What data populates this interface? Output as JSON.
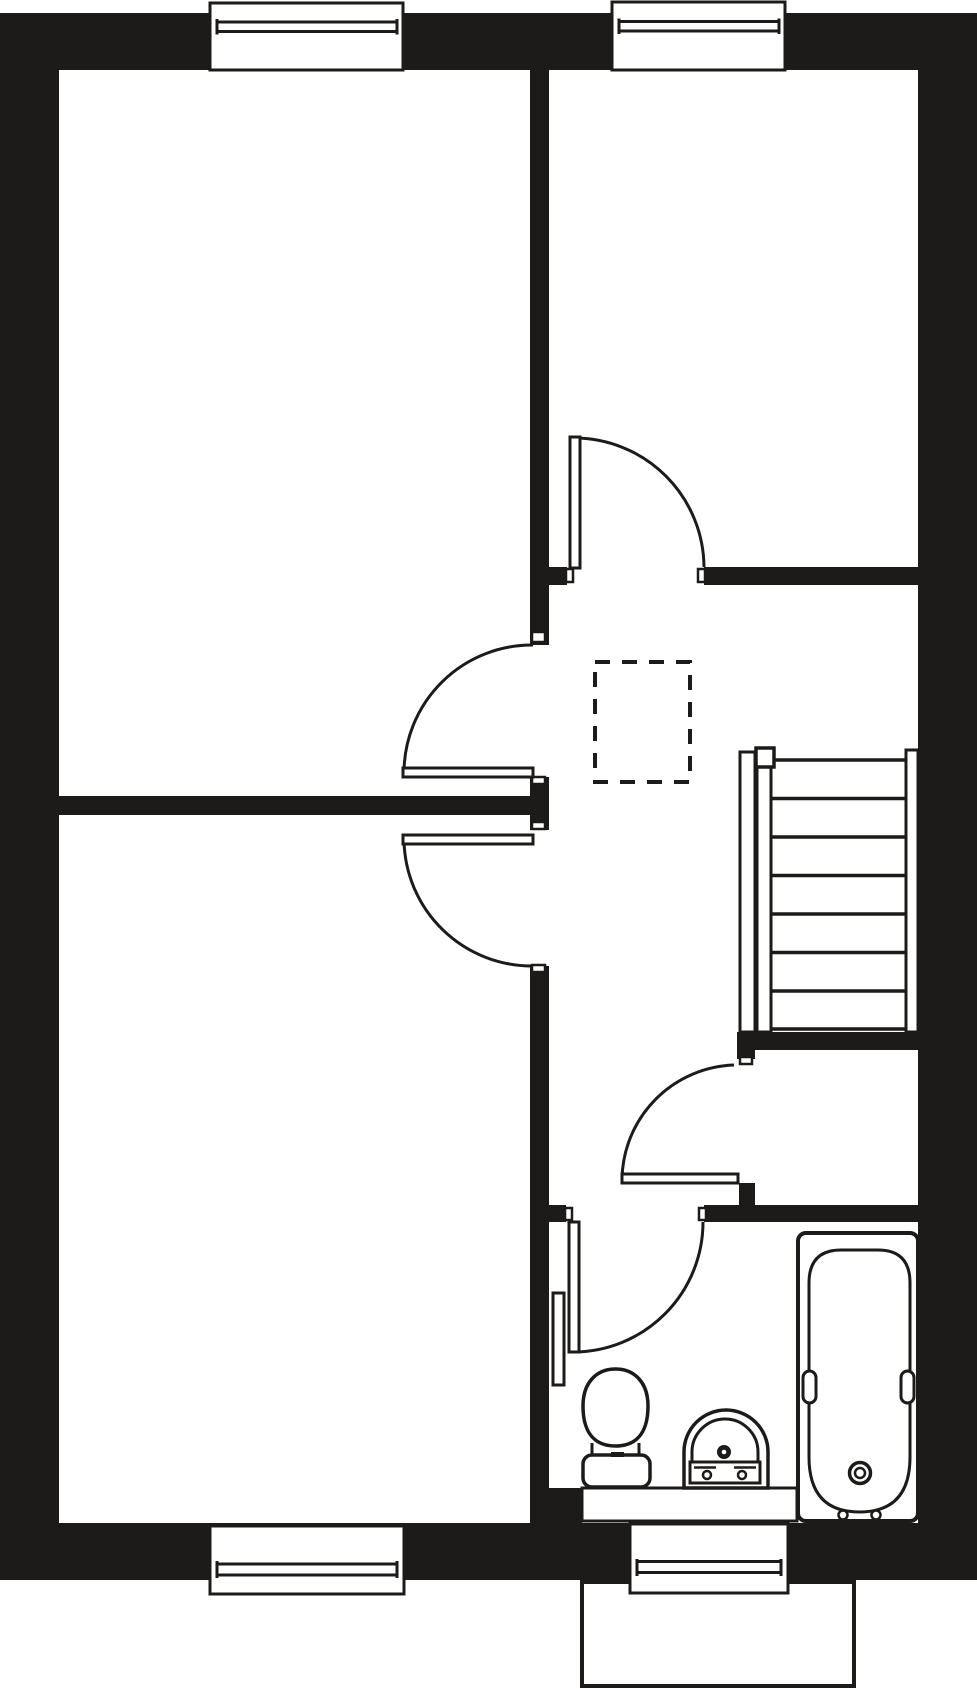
{
  "plan": {
    "w": 977,
    "h": 1689,
    "bg": "#ffffff",
    "ink": "#1d1b19"
  },
  "primitives": [
    {
      "kind": "rect",
      "name": "top-wall",
      "x": 0,
      "y": 13,
      "w": 977,
      "h": 57,
      "fill": "ink"
    },
    {
      "kind": "rect",
      "name": "left-wall",
      "x": 0,
      "y": 13,
      "w": 59,
      "h": 1566,
      "fill": "ink"
    },
    {
      "kind": "rect",
      "name": "right-wall",
      "x": 918,
      "y": 13,
      "w": 59,
      "h": 1566,
      "fill": "ink"
    },
    {
      "kind": "rect",
      "name": "bottom-wall",
      "x": 0,
      "y": 1523,
      "w": 977,
      "h": 57,
      "fill": "ink"
    },
    {
      "kind": "rect",
      "name": "partition-upper-wall",
      "x": 530,
      "y": 70,
      "w": 19,
      "h": 575,
      "fill": "ink"
    },
    {
      "kind": "rect",
      "name": "partition-mid-pier",
      "x": 530,
      "y": 777,
      "w": 19,
      "h": 53,
      "fill": "ink"
    },
    {
      "kind": "rect",
      "name": "partition-lower-wall",
      "x": 530,
      "y": 966,
      "w": 19,
      "h": 524,
      "fill": "ink"
    },
    {
      "kind": "rect",
      "name": "bath-sw-pier",
      "x": 530,
      "y": 1488,
      "w": 52,
      "h": 37,
      "fill": "ink"
    },
    {
      "kind": "rect",
      "name": "left-rooms-divider-wall",
      "x": 59,
      "y": 796,
      "w": 471,
      "h": 19,
      "fill": "ink"
    },
    {
      "kind": "rect",
      "name": "topright-room-south-stub",
      "x": 549,
      "y": 567,
      "w": 18,
      "h": 18,
      "fill": "ink"
    },
    {
      "kind": "rect",
      "name": "topright-room-south-wall",
      "x": 704,
      "y": 567,
      "w": 214,
      "h": 18,
      "fill": "ink"
    },
    {
      "kind": "rect",
      "name": "understairs-wall",
      "x": 737,
      "y": 1032,
      "w": 181,
      "h": 18,
      "fill": "ink"
    },
    {
      "kind": "rect",
      "name": "understairs-pier",
      "x": 737,
      "y": 1050,
      "w": 18,
      "h": 9,
      "fill": "ink"
    },
    {
      "kind": "rect",
      "name": "store-door-pier",
      "x": 739,
      "y": 1183,
      "w": 16,
      "h": 22,
      "fill": "ink"
    },
    {
      "kind": "rect",
      "name": "bathroom-north-stub",
      "x": 548,
      "y": 1205,
      "w": 18,
      "h": 17,
      "fill": "ink"
    },
    {
      "kind": "rect",
      "name": "bathroom-north-wall",
      "x": 704,
      "y": 1205,
      "w": 214,
      "h": 17,
      "fill": "ink"
    },
    {
      "kind": "rect",
      "name": "porch-outline",
      "x": 582,
      "y": 1582,
      "w": 272,
      "h": 104,
      "fill": "bg",
      "stroke": "ink",
      "sw": 4
    },
    {
      "kind": "rect",
      "name": "window-top-left-frame",
      "x": 210,
      "y": 3,
      "w": 193,
      "h": 67,
      "fill": "bg",
      "stroke": "ink",
      "sw": 3
    },
    {
      "kind": "line",
      "name": "window-top-left-glazing-1",
      "x1": 217,
      "y1": 22,
      "x2": 397,
      "y2": 22,
      "stroke": "ink",
      "sw": 3
    },
    {
      "kind": "line",
      "name": "window-top-left-glazing-2",
      "x1": 217,
      "y1": 31.5,
      "x2": 397,
      "y2": 31.5,
      "stroke": "ink",
      "sw": 3
    },
    {
      "kind": "line",
      "name": "window-top-left-cap-l",
      "x1": 217,
      "y1": 19,
      "x2": 217,
      "y2": 34.5,
      "stroke": "ink",
      "sw": 3
    },
    {
      "kind": "line",
      "name": "window-top-left-cap-r",
      "x1": 397,
      "y1": 19,
      "x2": 397,
      "y2": 34.5,
      "stroke": "ink",
      "sw": 3
    },
    {
      "kind": "rect",
      "name": "window-top-right-frame",
      "x": 612,
      "y": 2,
      "w": 173,
      "h": 68,
      "fill": "bg",
      "stroke": "ink",
      "sw": 3
    },
    {
      "kind": "line",
      "name": "window-top-right-glazing-1",
      "x1": 619,
      "y1": 21.5,
      "x2": 779,
      "y2": 21.5,
      "stroke": "ink",
      "sw": 3
    },
    {
      "kind": "line",
      "name": "window-top-right-glazing-2",
      "x1": 619,
      "y1": 31,
      "x2": 779,
      "y2": 31,
      "stroke": "ink",
      "sw": 3
    },
    {
      "kind": "line",
      "name": "window-top-right-cap-l",
      "x1": 619,
      "y1": 18.5,
      "x2": 619,
      "y2": 34,
      "stroke": "ink",
      "sw": 3
    },
    {
      "kind": "line",
      "name": "window-top-right-cap-r",
      "x1": 779,
      "y1": 18.5,
      "x2": 779,
      "y2": 34,
      "stroke": "ink",
      "sw": 3
    },
    {
      "kind": "rect",
      "name": "window-bottom-left-frame",
      "x": 210,
      "y": 1526,
      "w": 194,
      "h": 68,
      "fill": "bg",
      "stroke": "ink",
      "sw": 3
    },
    {
      "kind": "line",
      "name": "window-bottom-left-glazing-1",
      "x1": 217,
      "y1": 1564,
      "x2": 397,
      "y2": 1564,
      "stroke": "ink",
      "sw": 3
    },
    {
      "kind": "line",
      "name": "window-bottom-left-glazing-2",
      "x1": 217,
      "y1": 1575,
      "x2": 397,
      "y2": 1575,
      "stroke": "ink",
      "sw": 3
    },
    {
      "kind": "line",
      "name": "window-bottom-left-cap-l",
      "x1": 217,
      "y1": 1561,
      "x2": 217,
      "y2": 1578,
      "stroke": "ink",
      "sw": 3
    },
    {
      "kind": "line",
      "name": "window-bottom-left-cap-r",
      "x1": 397,
      "y1": 1561,
      "x2": 397,
      "y2": 1578,
      "stroke": "ink",
      "sw": 3
    },
    {
      "kind": "rect",
      "name": "window-bottom-right-frame",
      "x": 630,
      "y": 1524,
      "w": 158,
      "h": 69,
      "fill": "bg",
      "stroke": "ink",
      "sw": 3
    },
    {
      "kind": "line",
      "name": "window-bottom-right-glazing-1",
      "x1": 637,
      "y1": 1561.5,
      "x2": 781,
      "y2": 1561.5,
      "stroke": "ink",
      "sw": 3
    },
    {
      "kind": "line",
      "name": "window-bottom-right-glazing-2",
      "x1": 637,
      "y1": 1572.5,
      "x2": 781,
      "y2": 1572.5,
      "stroke": "ink",
      "sw": 3
    },
    {
      "kind": "line",
      "name": "window-bottom-right-cap-l",
      "x1": 637,
      "y1": 1559,
      "x2": 637,
      "y2": 1576,
      "stroke": "ink",
      "sw": 3
    },
    {
      "kind": "line",
      "name": "window-bottom-right-cap-r",
      "x1": 781,
      "y1": 1559,
      "x2": 781,
      "y2": 1576,
      "stroke": "ink",
      "sw": 3
    },
    {
      "kind": "rect",
      "name": "door-jamb",
      "x": 532,
      "y": 632,
      "w": 13,
      "h": 10,
      "fill": "bg",
      "stroke": "ink",
      "sw": 2.5
    },
    {
      "kind": "rect",
      "name": "door-jamb",
      "x": 532,
      "y": 777,
      "w": 13,
      "h": 7,
      "fill": "bg",
      "stroke": "ink",
      "sw": 2.5
    },
    {
      "kind": "rect",
      "name": "door-jamb",
      "x": 532,
      "y": 822,
      "w": 13,
      "h": 7,
      "fill": "bg",
      "stroke": "ink",
      "sw": 2.5
    },
    {
      "kind": "rect",
      "name": "door-jamb",
      "x": 532,
      "y": 965,
      "w": 13,
      "h": 7,
      "fill": "bg",
      "stroke": "ink",
      "sw": 2.5
    },
    {
      "kind": "rect",
      "name": "door-jamb",
      "x": 566,
      "y": 569,
      "w": 7,
      "h": 13,
      "fill": "bg",
      "stroke": "ink",
      "sw": 2.5
    },
    {
      "kind": "rect",
      "name": "door-jamb",
      "x": 698,
      "y": 569,
      "w": 7,
      "h": 13,
      "fill": "bg",
      "stroke": "ink",
      "sw": 2.5
    },
    {
      "kind": "rect",
      "name": "door-jamb",
      "x": 740,
      "y": 1025,
      "w": 12,
      "h": 7,
      "fill": "bg",
      "stroke": "ink",
      "sw": 2.5
    },
    {
      "kind": "rect",
      "name": "door-jamb",
      "x": 740,
      "y": 1057,
      "w": 12,
      "h": 7,
      "fill": "bg",
      "stroke": "ink",
      "sw": 2.5
    },
    {
      "kind": "rect",
      "name": "door-jamb",
      "x": 565,
      "y": 1208,
      "w": 7,
      "h": 12,
      "fill": "bg",
      "stroke": "ink",
      "sw": 2.5
    },
    {
      "kind": "rect",
      "name": "door-jamb",
      "x": 699,
      "y": 1208,
      "w": 7,
      "h": 12,
      "fill": "bg",
      "stroke": "ink",
      "sw": 2.5
    },
    {
      "kind": "path",
      "name": "door-swing-topright-room",
      "d": "M 575 438 A 130 130 0 0 1 704 567",
      "fill": "none",
      "stroke": "ink",
      "sw": 3
    },
    {
      "kind": "rect",
      "name": "door-leaf-topright-room",
      "x": 570,
      "y": 437,
      "w": 10,
      "h": 131,
      "fill": "bg",
      "stroke": "ink",
      "sw": 3
    },
    {
      "kind": "path",
      "name": "door-swing-topleft-room",
      "d": "M 404 772 A 128 128 0 0 1 533 645",
      "fill": "none",
      "stroke": "ink",
      "sw": 3
    },
    {
      "kind": "rect",
      "name": "door-leaf-topleft-room",
      "x": 403,
      "y": 768,
      "w": 130,
      "h": 9,
      "fill": "bg",
      "stroke": "ink",
      "sw": 3
    },
    {
      "kind": "path",
      "name": "door-swing-bottomleft-room",
      "d": "M 404 840 A 128 128 0 0 0 533 966",
      "fill": "none",
      "stroke": "ink",
      "sw": 3
    },
    {
      "kind": "rect",
      "name": "door-leaf-bottomleft-room",
      "x": 403,
      "y": 835,
      "w": 130,
      "h": 9,
      "fill": "bg",
      "stroke": "ink",
      "sw": 3
    },
    {
      "kind": "path",
      "name": "door-swing-store",
      "d": "M 622 1179 A 116 116 0 0 1 734 1065",
      "fill": "none",
      "stroke": "ink",
      "sw": 3
    },
    {
      "kind": "rect",
      "name": "door-leaf-store",
      "x": 622,
      "y": 1174,
      "w": 116,
      "h": 9,
      "fill": "bg",
      "stroke": "ink",
      "sw": 3
    },
    {
      "kind": "path",
      "name": "door-swing-bathroom",
      "d": "M 574 1352 A 130 130 0 0 0 703 1222",
      "fill": "none",
      "stroke": "ink",
      "sw": 3
    },
    {
      "kind": "rect",
      "name": "door-leaf-bathroom",
      "x": 569,
      "y": 1222,
      "w": 10,
      "h": 130,
      "fill": "bg",
      "stroke": "ink",
      "sw": 3
    },
    {
      "kind": "rect",
      "name": "stairs-left-rail-outer",
      "x": 740,
      "y": 752,
      "w": 15,
      "h": 280,
      "fill": "bg",
      "stroke": "ink",
      "sw": 3
    },
    {
      "kind": "rect",
      "name": "stairs-left-rail-inner",
      "x": 757,
      "y": 762,
      "w": 14,
      "h": 270,
      "fill": "bg",
      "stroke": "ink",
      "sw": 3
    },
    {
      "kind": "rect",
      "name": "stairs-right-rail",
      "x": 906,
      "y": 750,
      "w": 12,
      "h": 282,
      "fill": "bg",
      "stroke": "ink",
      "sw": 3
    },
    {
      "kind": "rect",
      "name": "stairs-newel-post",
      "x": 756,
      "y": 748,
      "w": 18,
      "h": 19,
      "fill": "bg",
      "stroke": "ink",
      "sw": 3.5
    },
    {
      "kind": "line",
      "name": "stair-tread",
      "x1": 774,
      "y1": 760,
      "x2": 906,
      "y2": 760,
      "stroke": "ink",
      "sw": 3.5
    },
    {
      "kind": "line",
      "name": "stair-tread",
      "x1": 771,
      "y1": 798.5,
      "x2": 906,
      "y2": 798.5,
      "stroke": "ink",
      "sw": 3.5
    },
    {
      "kind": "line",
      "name": "stair-tread",
      "x1": 771,
      "y1": 837,
      "x2": 906,
      "y2": 837,
      "stroke": "ink",
      "sw": 3.5
    },
    {
      "kind": "line",
      "name": "stair-tread",
      "x1": 771,
      "y1": 875.5,
      "x2": 906,
      "y2": 875.5,
      "stroke": "ink",
      "sw": 3.5
    },
    {
      "kind": "line",
      "name": "stair-tread",
      "x1": 771,
      "y1": 914,
      "x2": 906,
      "y2": 914,
      "stroke": "ink",
      "sw": 3.5
    },
    {
      "kind": "line",
      "name": "stair-tread",
      "x1": 771,
      "y1": 952.5,
      "x2": 906,
      "y2": 952.5,
      "stroke": "ink",
      "sw": 3.5
    },
    {
      "kind": "line",
      "name": "stair-tread",
      "x1": 771,
      "y1": 991,
      "x2": 906,
      "y2": 991,
      "stroke": "ink",
      "sw": 3.5
    },
    {
      "kind": "line",
      "name": "stair-tread",
      "x1": 771,
      "y1": 1029,
      "x2": 906,
      "y2": 1029,
      "stroke": "ink",
      "sw": 3.5
    },
    {
      "kind": "rect",
      "name": "void-dashed-box",
      "x": 595,
      "y": 662,
      "w": 95,
      "h": 120,
      "fill": "none",
      "stroke": "ink",
      "sw": 4,
      "dash": "15 12"
    },
    {
      "kind": "rect",
      "name": "bathroom-counter",
      "x": 582,
      "y": 1488,
      "w": 215,
      "h": 33,
      "fill": "bg",
      "stroke": "ink",
      "sw": 3
    },
    {
      "kind": "rect",
      "name": "radiator",
      "x": 553,
      "y": 1293,
      "w": 11,
      "h": 92,
      "fill": "bg",
      "stroke": "ink",
      "sw": 3
    },
    {
      "kind": "path",
      "name": "toilet-bowl",
      "d": "M 615.5 1369 C 634 1369 648 1382 648 1406 C 648 1428 640 1446 615.5 1446 C 591 1446 583 1428 583 1406 C 583 1382 597 1369 615.5 1369 Z",
      "fill": "bg",
      "stroke": "ink",
      "sw": 3.5
    },
    {
      "kind": "line",
      "name": "toilet-neck-left",
      "x1": 592,
      "y1": 1443,
      "x2": 592,
      "y2": 1457,
      "stroke": "ink",
      "sw": 3
    },
    {
      "kind": "line",
      "name": "toilet-neck-right",
      "x1": 639,
      "y1": 1443,
      "x2": 639,
      "y2": 1457,
      "stroke": "ink",
      "sw": 3
    },
    {
      "kind": "rect",
      "name": "toilet-cistern",
      "x": 583,
      "y": 1455,
      "w": 67,
      "h": 32,
      "rx": 9,
      "fill": "bg",
      "stroke": "ink",
      "sw": 3.5
    },
    {
      "kind": "rect",
      "name": "toilet-flush-button",
      "x": 611,
      "y": 1452,
      "w": 13,
      "h": 5,
      "fill": "ink"
    },
    {
      "kind": "path",
      "name": "basin-body",
      "d": "M 684 1488 L 684 1452 A 42 42 0 0 1 768 1452 L 768 1488 Z",
      "fill": "bg",
      "stroke": "ink",
      "sw": 3.5
    },
    {
      "kind": "path",
      "name": "basin-inner",
      "d": "M 692 1463 L 692 1452 A 33 33 0 0 1 758 1452 L 758 1463",
      "fill": "none",
      "stroke": "ink",
      "sw": 3
    },
    {
      "kind": "rect",
      "name": "basin-ledge",
      "x": 690,
      "y": 1462,
      "w": 70,
      "h": 21,
      "fill": "bg",
      "stroke": "ink",
      "sw": 3
    },
    {
      "kind": "line",
      "name": "basin-ledge-line-left",
      "x1": 694,
      "y1": 1467.5,
      "x2": 716,
      "y2": 1467.5,
      "stroke": "ink",
      "sw": 2.5
    },
    {
      "kind": "line",
      "name": "basin-ledge-line-right",
      "x1": 734,
      "y1": 1467.5,
      "x2": 756,
      "y2": 1467.5,
      "stroke": "ink",
      "sw": 2.5
    },
    {
      "kind": "circle",
      "name": "basin-tap-left",
      "cx": 707,
      "cy": 1475,
      "r": 4,
      "fill": "bg",
      "stroke": "ink",
      "sw": 2.5
    },
    {
      "kind": "circle",
      "name": "basin-tap-right",
      "cx": 742,
      "cy": 1475,
      "r": 4,
      "fill": "bg",
      "stroke": "ink",
      "sw": 2.5
    },
    {
      "kind": "circle",
      "name": "basin-faucet-dot",
      "cx": 724,
      "cy": 1452,
      "r": 7,
      "fill": "ink"
    },
    {
      "kind": "circle",
      "name": "basin-faucet-dot-center",
      "cx": 724,
      "cy": 1452,
      "r": 2.3,
      "fill": "bg"
    },
    {
      "kind": "rect",
      "name": "bath-outer",
      "x": 798,
      "y": 1233,
      "w": 120,
      "h": 288,
      "rx": 8,
      "fill": "bg",
      "stroke": "ink",
      "sw": 4
    },
    {
      "kind": "path",
      "name": "bath-tub-inner",
      "d": "M 809 1283 Q 809 1250 841 1250 L 878 1250 Q 910 1250 910 1283 L 910 1457 Q 910 1512 859.5 1512 Q 809 1512 809 1457 Z",
      "fill": "bg",
      "stroke": "ink",
      "sw": 3
    },
    {
      "kind": "rect",
      "name": "bath-grip-left",
      "x": 803,
      "y": 1371,
      "w": 13,
      "h": 32,
      "rx": 6.5,
      "fill": "bg",
      "stroke": "ink",
      "sw": 3
    },
    {
      "kind": "rect",
      "name": "bath-grip-right",
      "x": 901,
      "y": 1371,
      "w": 13,
      "h": 32,
      "rx": 6.5,
      "fill": "bg",
      "stroke": "ink",
      "sw": 3
    },
    {
      "kind": "circle",
      "name": "bath-drain-outer",
      "cx": 860,
      "cy": 1473,
      "r": 10.5,
      "fill": "bg",
      "stroke": "ink",
      "sw": 3.5
    },
    {
      "kind": "circle",
      "name": "bath-drain-inner",
      "cx": 860,
      "cy": 1473,
      "r": 5,
      "fill": "none",
      "stroke": "ink",
      "sw": 2.5
    },
    {
      "kind": "circle",
      "name": "bath-tap-left",
      "cx": 843,
      "cy": 1515,
      "r": 4.5,
      "fill": "bg",
      "stroke": "ink",
      "sw": 2.5
    },
    {
      "kind": "circle",
      "name": "bath-tap-right",
      "cx": 876,
      "cy": 1515,
      "r": 4.5,
      "fill": "bg",
      "stroke": "ink",
      "sw": 2.5
    }
  ]
}
